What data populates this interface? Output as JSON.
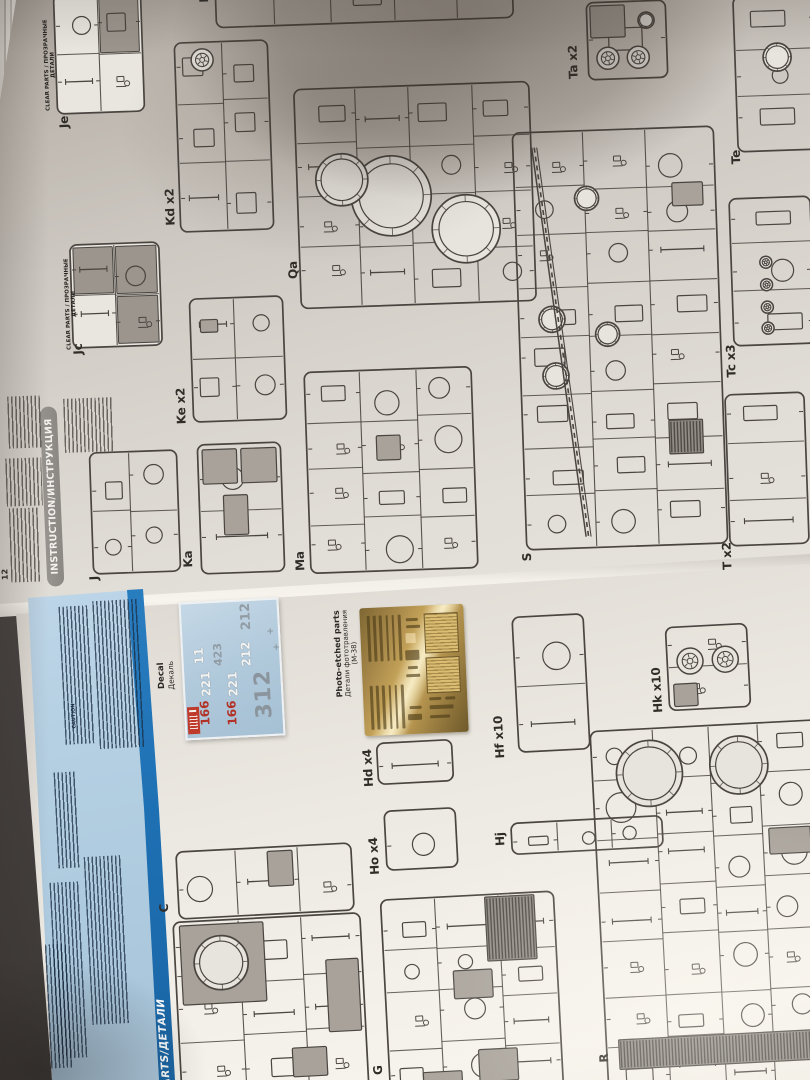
{
  "colors": {
    "table": "#3e3a37",
    "page": "#d9d5ce",
    "panel_blue": "#b2cde1",
    "stripe_blue": "#1d6fb2",
    "decal_blue": "#afc8da",
    "decal_red": "#b23227",
    "brass": "#caa85c",
    "ink": "#4a4540",
    "banner_gray": "#8f8c87"
  },
  "top_page": {
    "page_number": "12",
    "instruction_banner": "INSTRUCTION/ИНСТРУКЦИЯ",
    "clear_parts_header": "CLEAR PARTS / ПРОЗРАЧНЫЕ ДЕТАЛИ",
    "sprues": [
      {
        "label": "Je",
        "x": 54,
        "y": -8,
        "w": 90,
        "h": 122,
        "seed": 11,
        "clear": true,
        "lx": 66,
        "ly": 122
      },
      {
        "label": "K",
        "x": 214,
        "y": -34,
        "w": 300,
        "h": 58,
        "seed": 12,
        "lx": 206,
        "ly": -2
      },
      {
        "label": "Kd x2",
        "x": 176,
        "y": 40,
        "w": 96,
        "h": 192,
        "seed": 13,
        "wheels": [
          [
            0.3,
            0.1,
            11
          ]
        ],
        "lx": 172,
        "ly": 207
      },
      {
        "label": "Jc",
        "x": 70,
        "y": 242,
        "w": 92,
        "h": 106,
        "seed": 14,
        "clear": true,
        "lx": 80,
        "ly": 349
      },
      {
        "label": "Ke x2",
        "x": 190,
        "y": 296,
        "w": 96,
        "h": 126,
        "seed": 15,
        "gray": [
          [
            0.12,
            0.18,
            0.18,
            0.1
          ]
        ],
        "lx": 183,
        "ly": 406
      },
      {
        "label": "Qa",
        "x": 296,
        "y": 84,
        "w": 238,
        "h": 222,
        "seed": 16,
        "rings": [
          [
            0.4,
            0.5,
            40
          ],
          [
            0.71,
            0.66,
            34
          ],
          [
            0.195,
            0.42,
            26
          ]
        ],
        "lx": 295,
        "ly": 270
      },
      {
        "label": "Ka",
        "x": 198,
        "y": 442,
        "w": 86,
        "h": 132,
        "seed": 17,
        "gray": [
          [
            0.07,
            0.05,
            0.4,
            0.26
          ],
          [
            0.52,
            0.05,
            0.41,
            0.26
          ],
          [
            0.3,
            0.4,
            0.28,
            0.3
          ]
        ],
        "lx": 190,
        "ly": 559
      },
      {
        "label": "Ma",
        "x": 306,
        "y": 368,
        "w": 170,
        "h": 204,
        "seed": 18,
        "gray": [
          [
            0.42,
            0.33,
            0.14,
            0.12
          ]
        ],
        "lx": 302,
        "ly": 561
      },
      {
        "label": "J",
        "x": 90,
        "y": 450,
        "w": 90,
        "h": 124,
        "seed": 19,
        "lx": 96,
        "ly": 578
      },
      {
        "label": "S",
        "x": 518,
        "y": 128,
        "w": 204,
        "h": 420,
        "seed": 20,
        "rings": [
          [
            0.17,
            0.45,
            13
          ],
          [
            0.18,
            0.585,
            13
          ],
          [
            0.44,
            0.49,
            12
          ],
          [
            0.36,
            0.165,
            12
          ]
        ],
        "longs": [
          [
            0.1,
            0.04,
            0.3,
            0.97
          ]
        ],
        "hatch": [
          [
            0.725,
            0.7,
            0.165,
            0.08
          ]
        ],
        "gray": [
          [
            0.78,
            0.135,
            0.15,
            0.055
          ]
        ],
        "lx": 529,
        "ly": 557
      },
      {
        "label": "Ta x2",
        "x": 586,
        "y": 0,
        "w": 82,
        "h": 80,
        "seed": 21,
        "gray": [
          [
            0.06,
            0.06,
            0.42,
            0.4
          ]
        ],
        "wheels": [
          [
            0.26,
            0.72,
            11
          ],
          [
            0.63,
            0.72,
            11
          ]
        ],
        "rings": [
          [
            0.74,
            0.26,
            8
          ]
        ],
        "lx": 575,
        "ly": 62
      },
      {
        "label": "Te",
        "x": 734,
        "y": -6,
        "w": 84,
        "h": 158,
        "seed": 22,
        "rings": [
          [
            0.52,
            0.4,
            14
          ]
        ],
        "lx": 738,
        "ly": 157
      },
      {
        "label": "Tc x3",
        "x": 730,
        "y": 196,
        "w": 84,
        "h": 150,
        "seed": 23,
        "wheels": [
          [
            0.43,
            0.44,
            6
          ],
          [
            0.43,
            0.59,
            6
          ],
          [
            0.43,
            0.74,
            6
          ],
          [
            0.43,
            0.88,
            6
          ]
        ],
        "lx": 733,
        "ly": 361
      },
      {
        "label": "T x2",
        "x": 726,
        "y": 392,
        "w": 82,
        "h": 154,
        "seed": 24,
        "lx": 729,
        "ly": 556
      }
    ]
  },
  "bottom_page": {
    "parts_banner": "PARTS/ДЕТАЛИ",
    "caution_heading": "CAUTION",
    "decal": {
      "label_en": "Decal",
      "label_ru": "Декаль",
      "numbers": [
        {
          "t": "212",
          "c": "gray",
          "x": 246,
          "y": 617,
          "s": 13
        },
        {
          "t": "11",
          "c": "white",
          "x": 199,
          "y": 657,
          "s": 12
        },
        {
          "t": "423",
          "c": "gray",
          "x": 218,
          "y": 656,
          "s": 11
        },
        {
          "t": "212",
          "c": "white",
          "x": 246,
          "y": 655,
          "s": 12
        },
        {
          "t": "+",
          "c": "cross",
          "x": 271,
          "y": 634,
          "s": 9
        },
        {
          "t": "+",
          "c": "cross",
          "x": 277,
          "y": 650,
          "s": 9
        },
        {
          "t": "221",
          "c": "white",
          "x": 206,
          "y": 685,
          "s": 12
        },
        {
          "t": "221",
          "c": "white",
          "x": 233,
          "y": 685,
          "s": 12
        },
        {
          "t": "166",
          "c": "red",
          "x": 205,
          "y": 714,
          "s": 12
        },
        {
          "t": "166",
          "c": "red",
          "x": 232,
          "y": 714,
          "s": 12
        },
        {
          "t": "312",
          "c": "big",
          "x": 264,
          "y": 692,
          "s": 22
        }
      ]
    },
    "photo_etched": {
      "line1": "Photo-etched parts",
      "line2": "Детали фототравления",
      "line3": "(М-38)"
    },
    "sprues": [
      {
        "label": "Hf x10",
        "x": 514,
        "y": 614,
        "w": 74,
        "h": 138,
        "seed": 31,
        "lx": 501,
        "ly": 737
      },
      {
        "label": "Hk x10",
        "x": 666,
        "y": 624,
        "w": 84,
        "h": 86,
        "seed": 32,
        "wheels": [
          [
            0.29,
            0.42,
            13
          ],
          [
            0.71,
            0.42,
            13
          ]
        ],
        "gray": [
          [
            0.08,
            0.68,
            0.28,
            0.26
          ]
        ],
        "lx": 659,
        "ly": 690
      },
      {
        "label": "Hd x4",
        "x": 376,
        "y": 740,
        "w": 78,
        "h": 44,
        "seed": 33,
        "lx": 370,
        "ly": 768
      },
      {
        "label": "Ho x4",
        "x": 384,
        "y": 808,
        "w": 74,
        "h": 62,
        "seed": 34,
        "lx": 376,
        "ly": 856
      },
      {
        "label": "Hj",
        "x": 510,
        "y": 818,
        "w": 154,
        "h": 34,
        "seed": 35,
        "lx": 502,
        "ly": 839
      },
      {
        "label": "R",
        "x": 598,
        "y": 724,
        "w": 230,
        "h": 370,
        "seed": 36,
        "rings": [
          [
            0.255,
            0.125,
            33
          ],
          [
            0.645,
            0.115,
            29
          ]
        ],
        "hatch": [
          [
            0.06,
            0.84,
            0.86,
            0.08
          ]
        ],
        "gray": [
          [
            0.76,
            0.29,
            0.18,
            0.07
          ]
        ],
        "lx": 606,
        "ly": 1058
      },
      {
        "label": "C",
        "x": 176,
        "y": 846,
        "w": 178,
        "h": 70,
        "seed": 37,
        "gray": [
          [
            0.52,
            0.08,
            0.14,
            0.5
          ]
        ],
        "lx": 166,
        "ly": 908
      },
      {
        "label": "",
        "x": 176,
        "y": 916,
        "w": 190,
        "h": 180,
        "seed": 38,
        "gray": [
          [
            0.04,
            0.03,
            0.44,
            0.44
          ],
          [
            0.8,
            0.26,
            0.17,
            0.4
          ],
          [
            0.6,
            0.74,
            0.18,
            0.16
          ]
        ],
        "rings": [
          [
            0.25,
            0.245,
            27
          ]
        ]
      },
      {
        "label": "G",
        "x": 384,
        "y": 894,
        "w": 176,
        "h": 200,
        "seed": 39,
        "hatch": [
          [
            0.6,
            0.02,
            0.28,
            0.32
          ]
        ],
        "gray": [
          [
            0.4,
            0.38,
            0.22,
            0.14
          ],
          [
            0.52,
            0.78,
            0.22,
            0.16
          ],
          [
            0.2,
            0.88,
            0.22,
            0.11
          ]
        ],
        "lx": 380,
        "ly": 1070
      }
    ]
  },
  "fineprint_blocks": {
    "top": [
      [
        8,
        396,
        34,
        52
      ],
      [
        64,
        398,
        50,
        54
      ],
      [
        6,
        458,
        36,
        48
      ],
      [
        10,
        508,
        30,
        74
      ]
    ],
    "panel": [
      [
        96,
        600,
        46,
        148
      ],
      [
        62,
        606,
        30,
        138
      ],
      [
        56,
        772,
        22,
        96
      ],
      [
        88,
        856,
        38,
        168
      ],
      [
        54,
        882,
        30,
        176
      ],
      [
        48,
        944,
        22,
        124
      ]
    ]
  }
}
